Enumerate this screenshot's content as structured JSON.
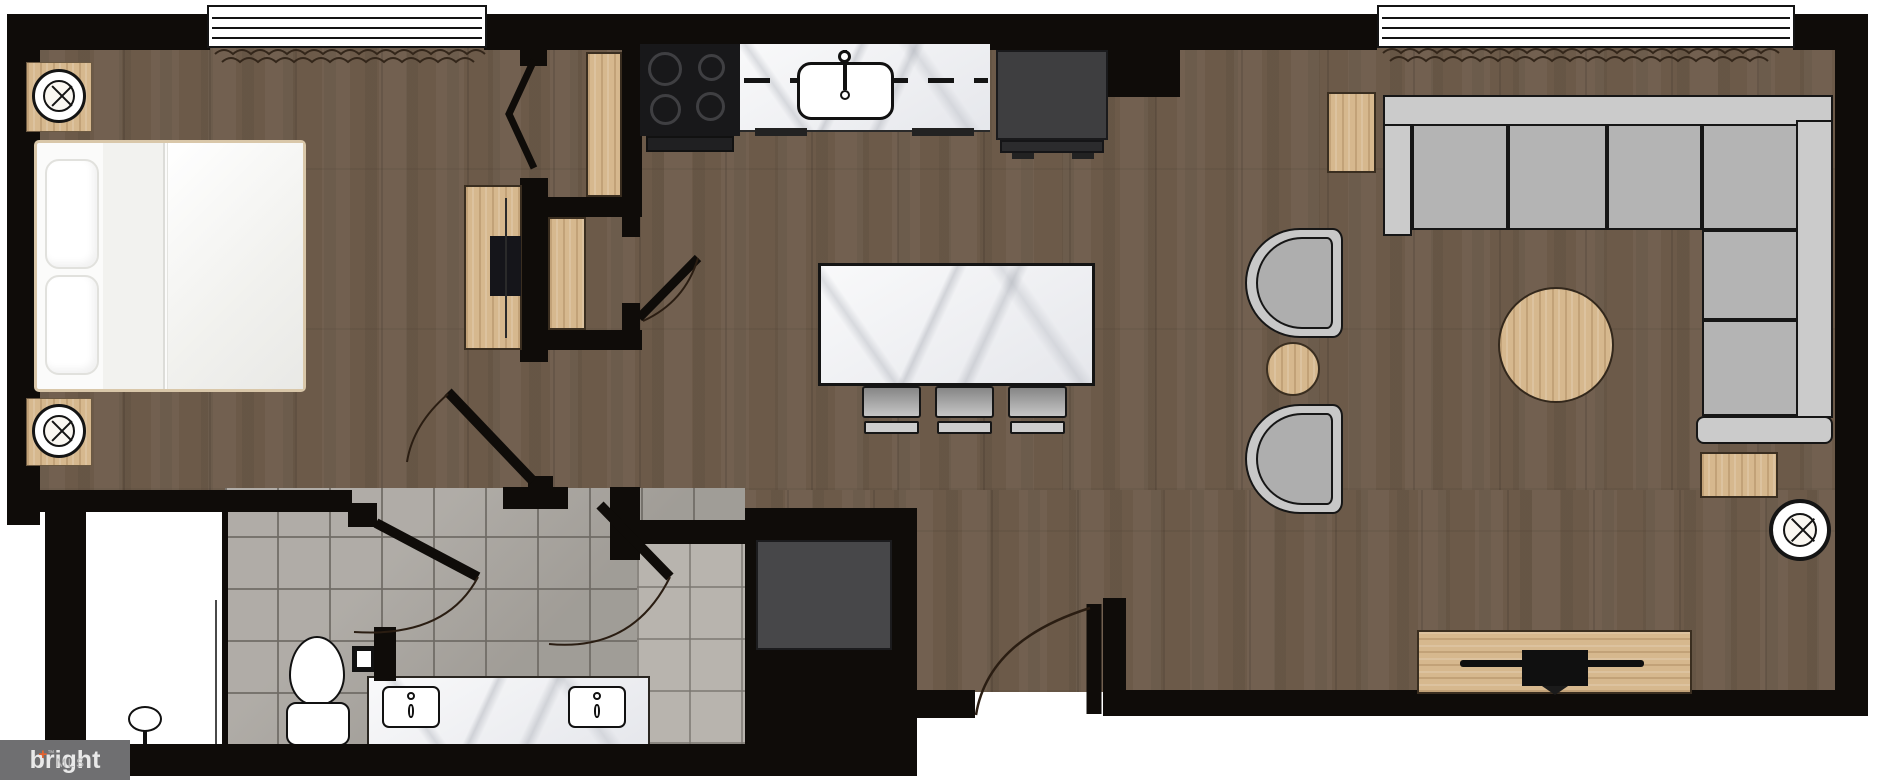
{
  "watermark": {
    "brand": "bright",
    "plus": "+",
    "tm": "™",
    "suffix": "MLS"
  },
  "floor_plan": {
    "type": "residential-floor-plan",
    "description": "Furnished one-bedroom apartment floor plan, top-down view",
    "rooms": [
      {
        "name": "Bedroom",
        "items": [
          "queen-bed",
          "ceiling-speaker",
          "ceiling-speaker",
          "dresser-with-tv",
          "bifold-closet-door",
          "wardrobe-panel",
          "tall-cabinet"
        ]
      },
      {
        "name": "Kitchen",
        "items": [
          "range-cooktop",
          "marble-counter-with-sink",
          "refrigerator",
          "marble-island",
          "bar-stool",
          "bar-stool",
          "bar-stool"
        ]
      },
      {
        "name": "Living Room",
        "items": [
          "sectional-sofa",
          "accent-chair",
          "accent-chair",
          "round-side-table",
          "round-area-rug",
          "side-table",
          "side-table",
          "media-console-with-tv",
          "ceiling-speaker"
        ]
      },
      {
        "name": "Bathroom",
        "items": [
          "walk-in-shower",
          "toilet",
          "toilet-paper-holder",
          "double-vanity"
        ]
      },
      {
        "name": "Laundry Closet",
        "items": [
          "washer-dryer"
        ]
      },
      {
        "name": "Entry",
        "items": [
          "entry-door-swing"
        ]
      }
    ],
    "windows": 2,
    "colors": {
      "wall": "#0f0c09",
      "wood_floor": "#6c5a49",
      "bath_tile": "#a7a39d",
      "light_wood": "#d6b88e",
      "marble": "#edeef1",
      "sofa_gray": "#b4b4b4",
      "appliance_dark": "#3e3e40",
      "logo_background": "#6f6f71",
      "logo_accent": "#e8622d"
    }
  }
}
